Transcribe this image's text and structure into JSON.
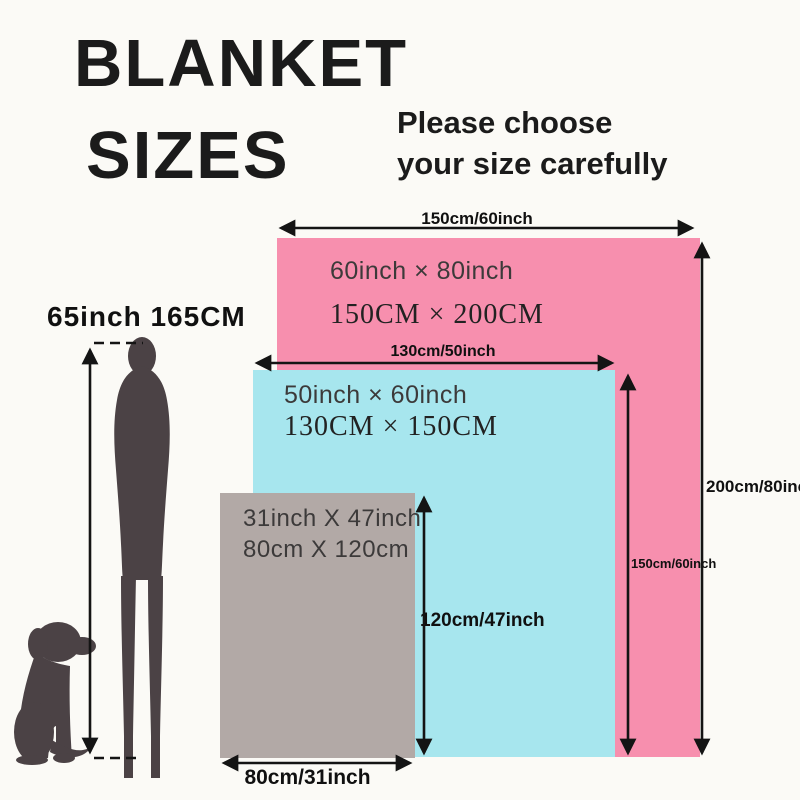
{
  "page": {
    "title_line1": "BLANKET",
    "title_line2": "SIZES",
    "subtitle_line1": "Please choose",
    "subtitle_line2": "your size carefully"
  },
  "person": {
    "height_label": "65inch 165CM"
  },
  "blankets": [
    {
      "size_name": "large",
      "color": "#f78fae",
      "inch_label": "60inch × 80inch",
      "cm_label": "150CM × 200CM",
      "width_label": "150cm/60inch",
      "height_label": "200cm/80inch"
    },
    {
      "size_name": "medium",
      "color": "#a7e6ee",
      "inch_label": "50inch × 60inch",
      "cm_label": "130CM × 150CM",
      "width_label": "130cm/50inch",
      "height_label": "150cm/60inch"
    },
    {
      "size_name": "small",
      "color": "#b2a9a6",
      "inch_label": "31inch X 47inch",
      "cm_label": "80cm X 120cm",
      "width_label": "80cm/31inch",
      "height_label": "120cm/47inch"
    }
  ],
  "colors": {
    "background": "#fbfaf6",
    "text": "#1b1b1b",
    "arrow": "#141414",
    "silhouette": "#4b4245",
    "blanket_pink": "#f78fae",
    "blanket_blue": "#a7e6ee",
    "blanket_gray": "#b2a9a6"
  }
}
